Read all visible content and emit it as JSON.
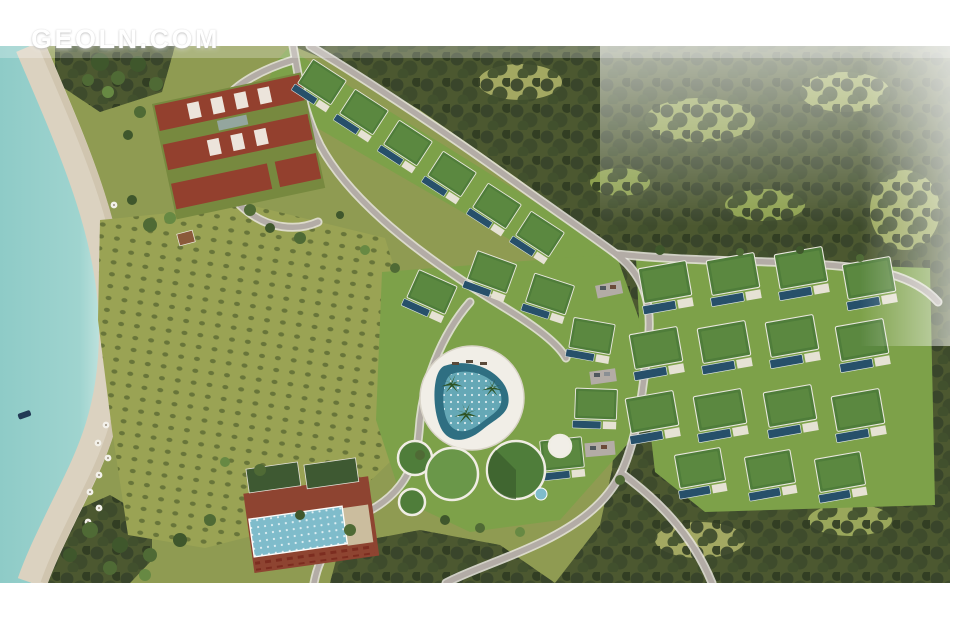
{
  "watermark": {
    "text": "GEOLN.COM",
    "color": "#ffffff"
  },
  "scene": {
    "type": "aerial-resort-masterplan-render",
    "description": "Bird's-eye architectural rendering of a seaside villa resort: turquoise bay and sandy beach on the left, olive grove field, hotel complex with terracotta roofs, clusters of green-roof villas with lap pools, central lagoon pool amenity with round pavilions, beach club with long pool, dense forest across the right half crossed by winding roads.",
    "palette": {
      "page_bg": "#ffffff",
      "watermark": "#ffffff",
      "sea": "#9fd4cf",
      "sea_deep": "#8ecbc7",
      "sea_shallow": "#d2ebe6",
      "sand": "#dbd2c0",
      "sand_dark": "#c7b9a0",
      "field": "#9aa354",
      "field_dot": "#5f6d35",
      "land": "#8f9b52",
      "lawn": "#7da149",
      "villa_roof": "#4f7d3a",
      "villa_roof_light": "#6a9749",
      "pool_dark": "#27506a",
      "pool_light": "#7fbccb",
      "lagoon": "#2f6f82",
      "lagoon_light": "#6fb3c0",
      "forest_base": "#4c5830",
      "forest_dark": "#37432a",
      "clearing": "#a3a862",
      "road": "#b3aca6",
      "road_light": "#e9e5df",
      "terracotta": "#8e4431",
      "roof_red": "#93402e",
      "club_roof": "#3e5932",
      "deck_white": "#f1eee7",
      "boat": "#223a55"
    }
  }
}
